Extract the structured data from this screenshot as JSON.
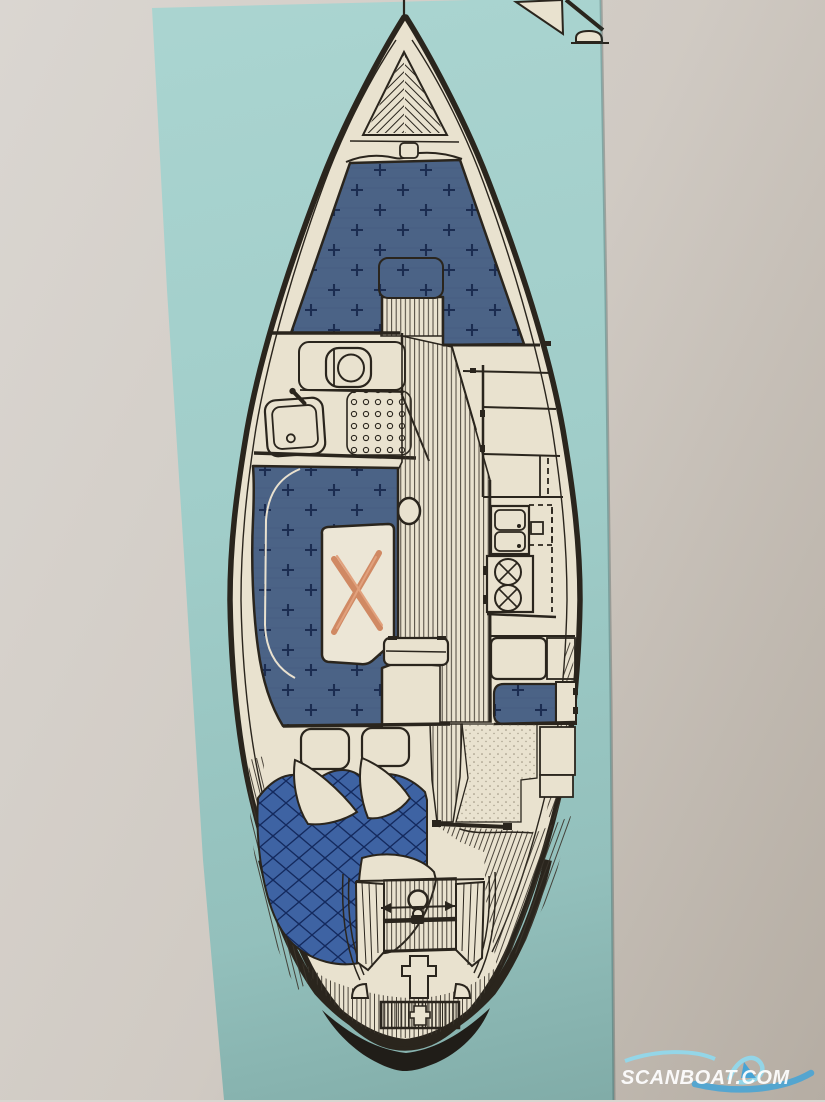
{
  "scene": {
    "wall": {
      "color_top": "#dad6d1",
      "color_mid": "#d0cac3",
      "color_bottom": "#b5ada3"
    },
    "paper": {
      "color_top": "#abd5d1",
      "color_mid": "#a0cdc9",
      "color_low": "#93c0bc",
      "color_dark": "#7da8a4"
    },
    "watermark": {
      "text": "SCANBOAT.COM",
      "text_color": "#ffffff",
      "wave_light": "#8fd9ee",
      "wave_dark": "#47a4d5"
    }
  },
  "diagram": {
    "ink": "#2a251d",
    "deck": "#e9e2cf",
    "table_top": "#ece6d6",
    "cushion": "#4b6386",
    "cushion_mark": "#1b2c50",
    "quilt": "#3e63a3",
    "quilt_line": "#142a5e",
    "crayon_x": "#cd7f57",
    "transom": "#201d18",
    "parts": [
      "bow-anchor-locker",
      "v-berth",
      "head-toilet",
      "head-sink",
      "shower-grate",
      "starboard-lockers",
      "saloon-settee",
      "saloon-table",
      "crayon-x-mark",
      "mast-post",
      "galley-double-sink",
      "icebox",
      "galley-stove",
      "chart-table",
      "nav-seat",
      "companionway-step",
      "quarter-berth-pillows",
      "quarter-berth",
      "aft-lockers",
      "cockpit-benches",
      "cockpit-sole",
      "steering-pedestal",
      "mainsheet-traveler",
      "stern-grate",
      "transom"
    ]
  }
}
